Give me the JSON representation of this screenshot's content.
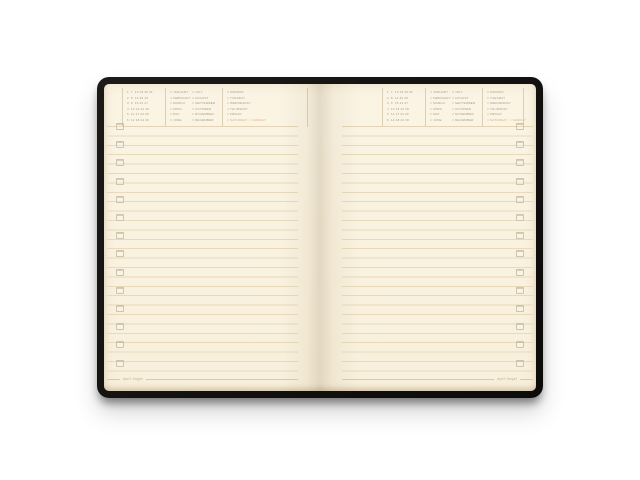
{
  "colors": {
    "background": "#ffffff",
    "cover_black": "#14110f",
    "paper_cream": "#faf3e1",
    "rule_line": "#e7d9ba",
    "header_text_gray": "#a39c8d",
    "weekend_orange": "#dfa878"
  },
  "planner": {
    "header": {
      "checkbox_glyph": "□",
      "date_grid_rows": [
        "1  7  13 19 25 31",
        "2  8  14 20 26",
        "3  9  15 21 27",
        "4  10 16 22 28",
        "5  11 17 23 29",
        "6  12 18 24 30"
      ],
      "months_column1": [
        "JANUARY",
        "FEBRUARY",
        "MARCH",
        "APRIL",
        "MAY",
        "JUNE"
      ],
      "months_column2": [
        "JULY",
        "AUGUST",
        "SEPTEMBER",
        "OCTOBER",
        "NOVEMBER",
        "DECEMBER"
      ],
      "weekdays": [
        "MONDAY",
        "TUESDAY",
        "WEDNESDAY",
        "THURSDAY",
        "FRIDAY"
      ],
      "weekend_days": [
        "SATURDAY",
        "SUNDAY"
      ]
    },
    "footer": {
      "left_page_label": "don't forget",
      "right_page_label": "don't forget"
    },
    "margin_checkbox_count": 14
  }
}
